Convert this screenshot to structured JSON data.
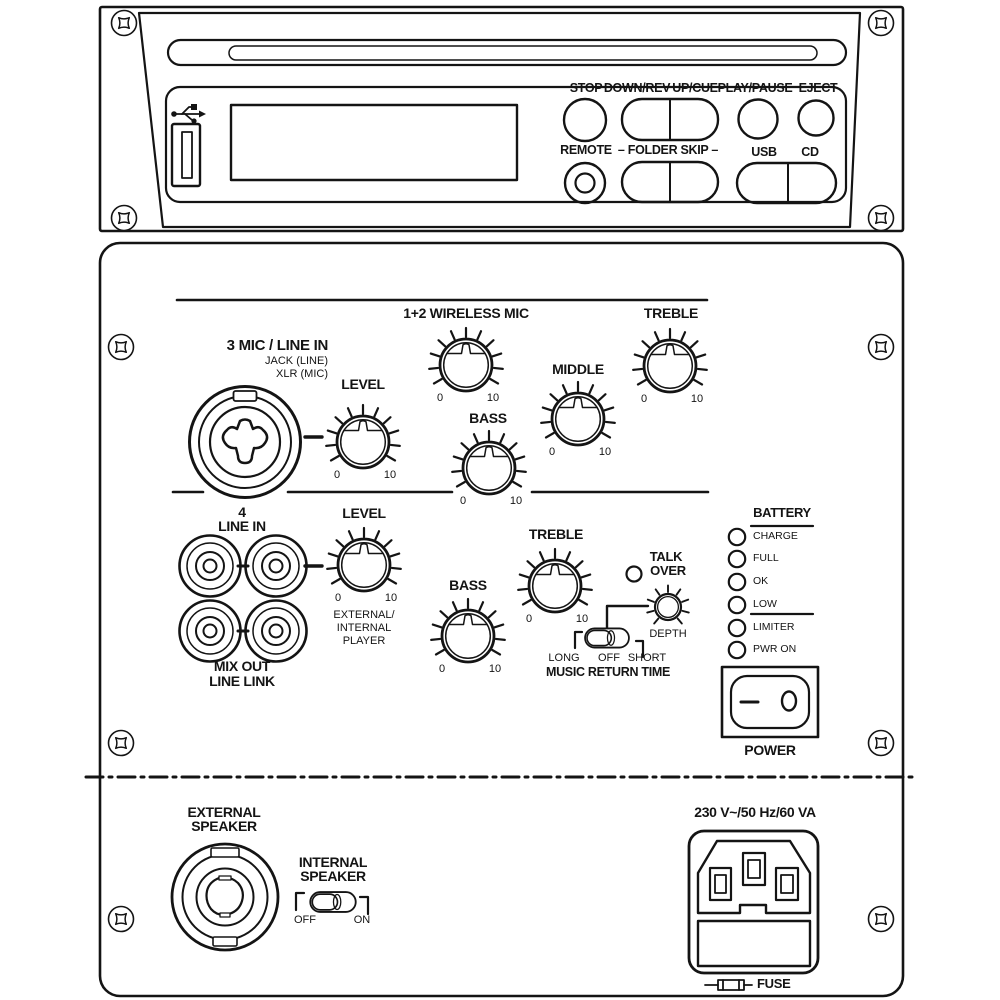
{
  "cd_panel": {
    "buttons": {
      "stop": "STOP",
      "down_rev": "DOWN/REV",
      "up_cue": "UP/CUE",
      "play_pause": "PLAY/PAUSE",
      "eject": "EJECT",
      "remote": "REMOTE",
      "folder_skip": "– FOLDER SKIP –",
      "usb": "USB",
      "cd": "CD"
    }
  },
  "mixer": {
    "mic3": {
      "title": "3 MIC / LINE IN",
      "sub_jack": "JACK (LINE)",
      "sub_xlr": "XLR (MIC)"
    },
    "knobs": {
      "level1": "LEVEL",
      "wireless": "1+2 WIRELESS MIC",
      "bass1": "BASS",
      "middle": "MIDDLE",
      "treble1": "TREBLE",
      "level2": "LEVEL",
      "bass2": "BASS",
      "treble2": "TREBLE",
      "depth": "DEPTH"
    },
    "scale": {
      "min": "0",
      "max": "10"
    },
    "line4": {
      "num": "4",
      "label": "LINE IN"
    },
    "level2_sub": [
      "EXTERNAL/",
      "INTERNAL",
      "PLAYER"
    ],
    "mix_out": {
      "line1": "MIX OUT",
      "line2": "LINE LINK"
    },
    "talk_over": {
      "line1": "TALK",
      "line2": "OVER"
    },
    "music_return": {
      "long": "LONG",
      "off": "OFF",
      "short": "SHORT",
      "title": "MUSIC RETURN TIME"
    },
    "battery": {
      "title": "BATTERY",
      "leds": [
        "CHARGE",
        "FULL",
        "OK",
        "LOW",
        "LIMITER",
        "PWR ON"
      ]
    },
    "power_label": "POWER"
  },
  "bottom_panel": {
    "external_speaker": {
      "line1": "EXTERNAL",
      "line2": "SPEAKER"
    },
    "internal_speaker": {
      "line1": "INTERNAL",
      "line2": "SPEAKER",
      "off": "OFF",
      "on": "ON"
    },
    "mains_rating": "230 V~/50 Hz/60 VA",
    "fuse_label": "FUSE"
  },
  "colors": {
    "ink": "#141414",
    "panel": "#ffffff"
  }
}
